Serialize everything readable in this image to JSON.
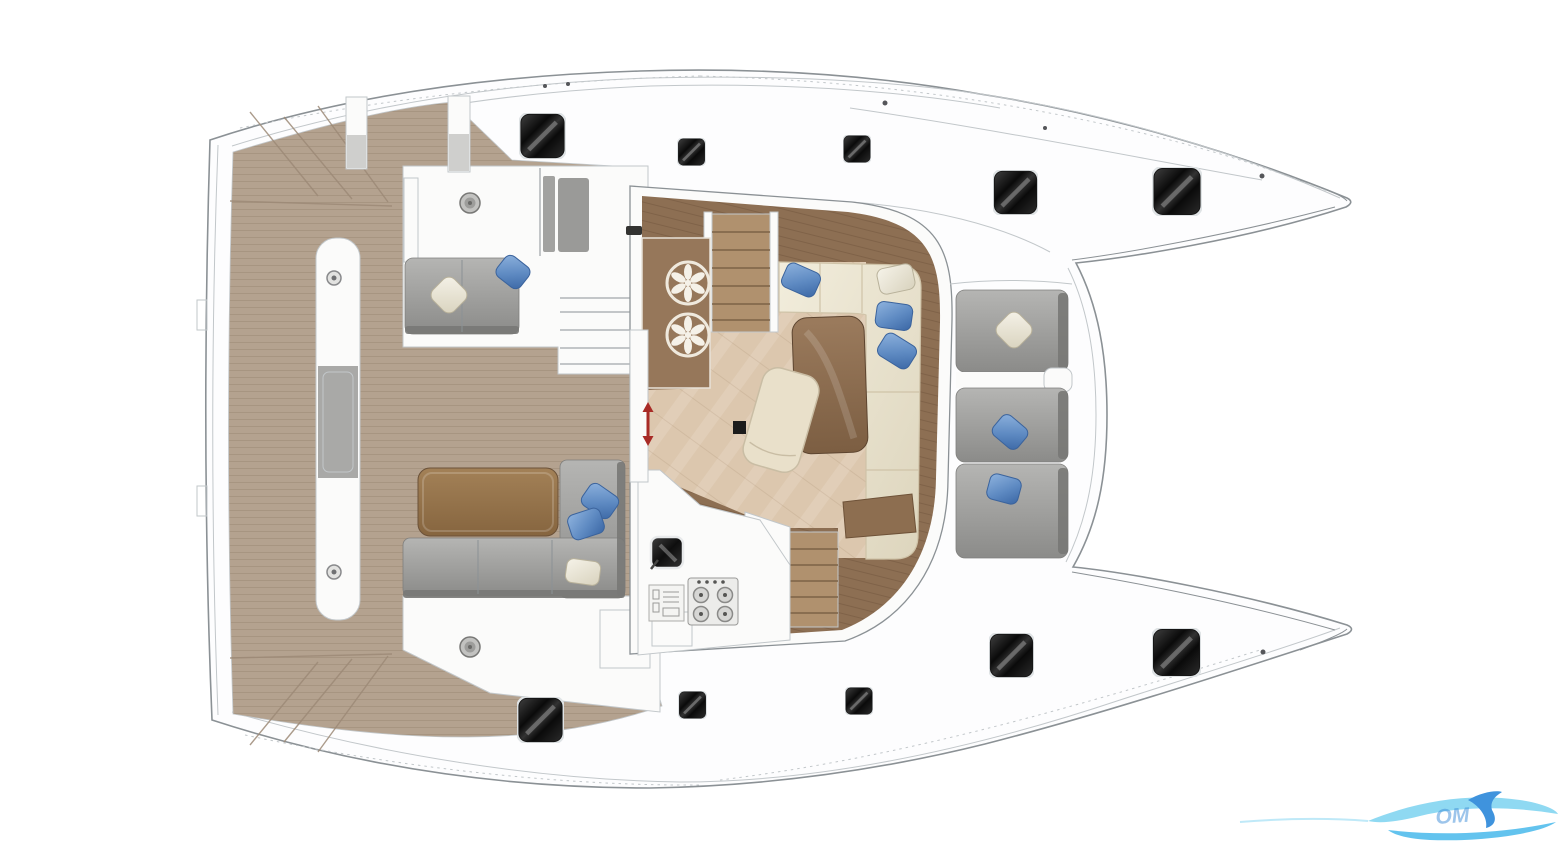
{
  "image": {
    "kind": "catamaran-deck-floorplan-rendering",
    "background": "#ffffff"
  },
  "watermark": {
    "visible_text": "OM"
  },
  "colors": {
    "teak": "#b4a28f",
    "teak_line": "#9c8a77",
    "wood_band": "#8d6f53",
    "wood_counter": "#96775a",
    "wood_table": "#8a6a4c",
    "wood_steps": "#b0916e",
    "wood_steps_line": "#7c6347",
    "salon_floor": "#dcc7ae",
    "cream_sofa": "#ece3cf",
    "cream_line": "#cfc3a8",
    "gray_seat": "#a5a5a3",
    "gray_seat_dark": "#787876",
    "pillow_blue_dark": "#3b639c",
    "hatch_ring": "#dfe3e5",
    "hull_line": "#8b9195",
    "hull_line_light": "#c2c7ca",
    "deck_white": "#fbfbfa",
    "arrow_red": "#a82b26",
    "logo_light": "#8fd9f2",
    "logo_mid": "#63c3ee",
    "logo_dark": "#3f93dd"
  },
  "inventory": {
    "deck_hatches_large": 6,
    "deck_hatches_small": 4,
    "winches": 2,
    "bench_fittings": 2,
    "galley_island_burners": 2,
    "stove_burners": 4,
    "blue_pillows": 8,
    "white_pillows": 4,
    "companionway_stairs": 2,
    "helm_step_sets": 1,
    "transom_step_areas": 2,
    "sliding_door_indicators": 1
  },
  "regions": [
    "aft-teak-deck",
    "port-transom-steps",
    "starboard-transom-steps",
    "aft-center-bench",
    "helm-station",
    "aft-cockpit-sofa",
    "aft-cockpit-table",
    "salon",
    "galley-island",
    "galley-counter",
    "salon-sofa",
    "salon-table",
    "salon-chaise",
    "forward-cockpit-seats",
    "port-hull-bow",
    "starboard-hull-bow"
  ]
}
